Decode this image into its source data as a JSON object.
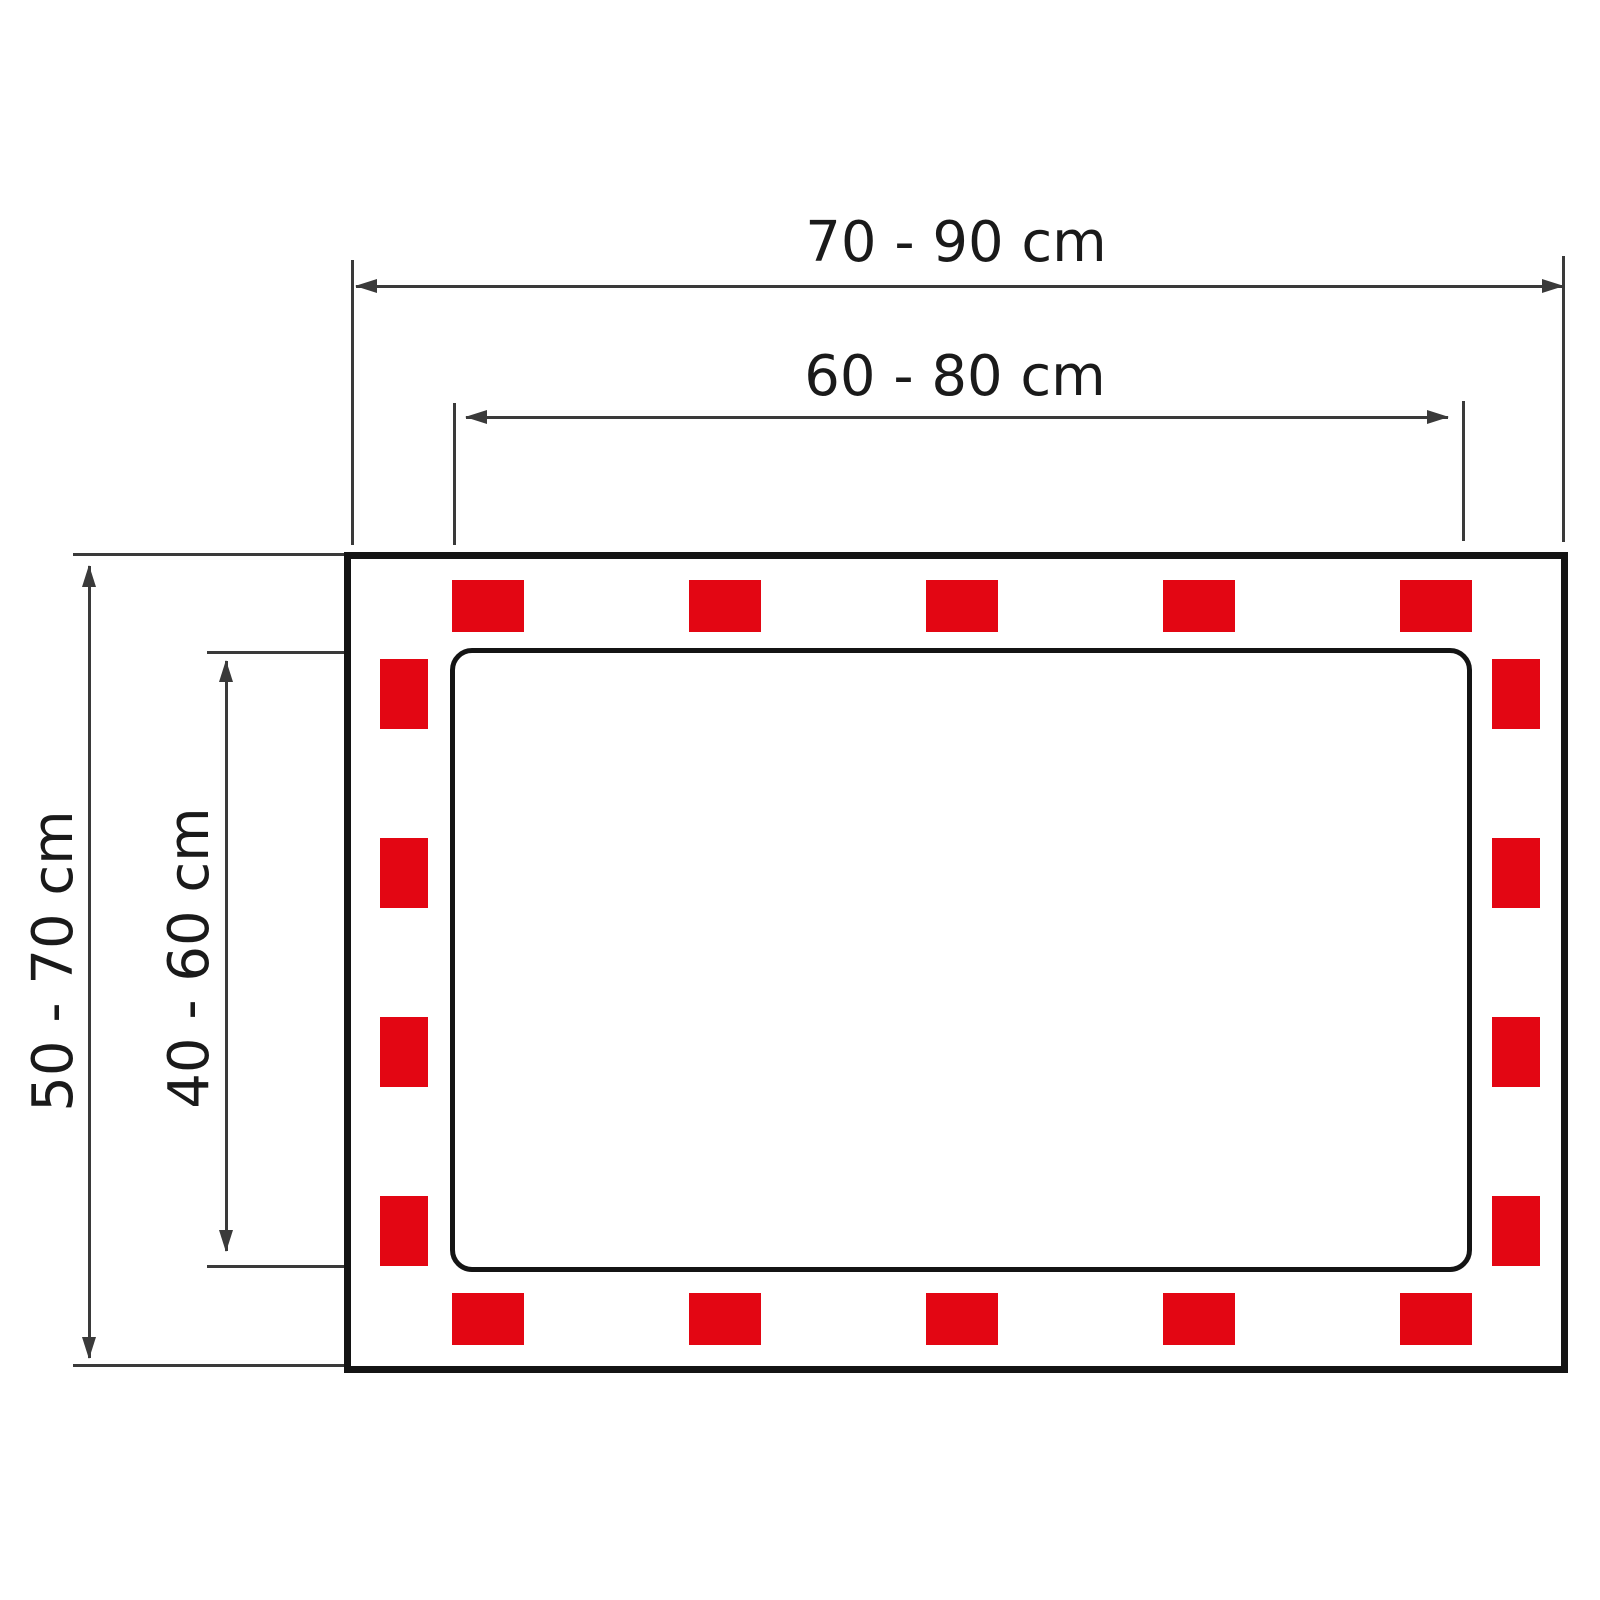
{
  "dimensions": {
    "outer_width_label": "70 - 90 cm",
    "inner_width_label": "60 - 80 cm",
    "outer_height_label": "50 - 70 cm",
    "inner_height_label": "40 - 60 cm"
  },
  "colors": {
    "marker_red": "#e30613",
    "outline_black": "#141414",
    "dimension_gray": "#3a3a3a"
  },
  "markers": {
    "top_count": 5,
    "bottom_count": 5,
    "left_count": 4,
    "right_count": 4,
    "top_x": [
      452,
      689,
      926,
      1163,
      1400
    ],
    "bottom_x": [
      452,
      689,
      926,
      1163,
      1400
    ],
    "left_y": [
      659,
      838,
      1017,
      1196
    ],
    "right_y": [
      659,
      838,
      1017,
      1196
    ],
    "top_row_y": 580,
    "bottom_row_y": 1293,
    "left_col_x": 380,
    "right_col_x": 1492
  }
}
